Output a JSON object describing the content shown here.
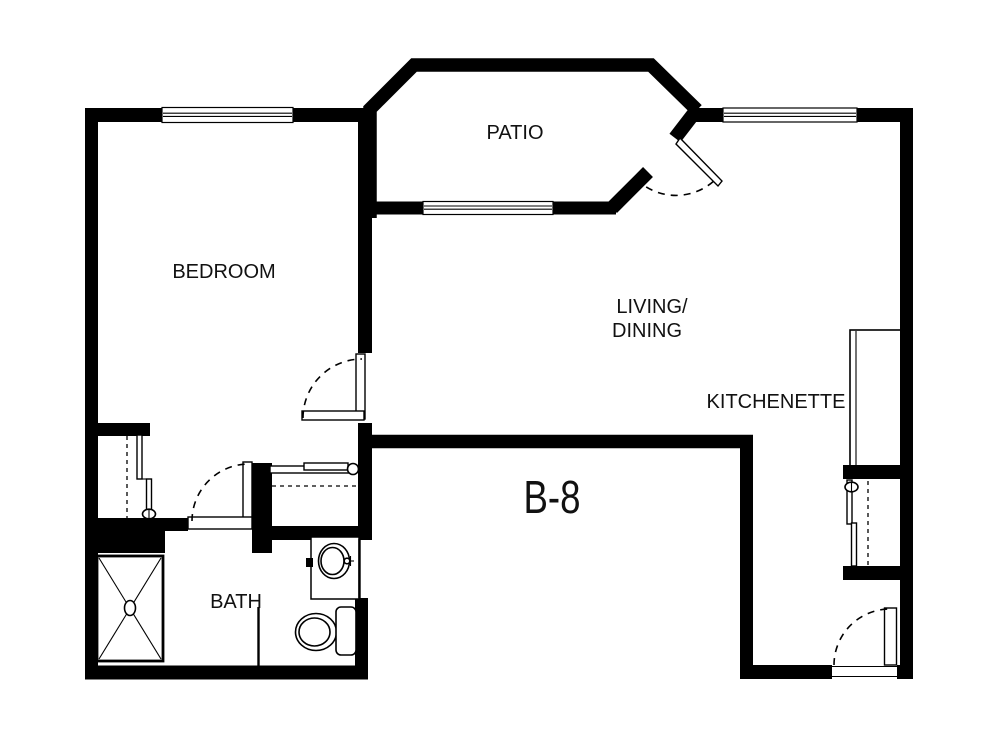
{
  "unit_label": "B-8",
  "rooms": {
    "patio": "PATIO",
    "bedroom": "BEDROOM",
    "living_line1": "LIVING/",
    "living_line2": "DINING",
    "kitchenette": "KITCHENETTE",
    "bath": "BATH"
  },
  "colors": {
    "walls": "#000000",
    "background": "#ffffff",
    "text": "#111111"
  },
  "windows": [
    "bedroom-window",
    "patio-window",
    "living-window"
  ],
  "doors": [
    "bedroom-door",
    "bath-door",
    "patio-door",
    "entry-door"
  ],
  "fixtures": [
    "shower",
    "bathroom-sink",
    "vanity-counter",
    "toilet",
    "bedroom-closet",
    "hall-closet",
    "kitchenette-counter",
    "entry-closet"
  ]
}
